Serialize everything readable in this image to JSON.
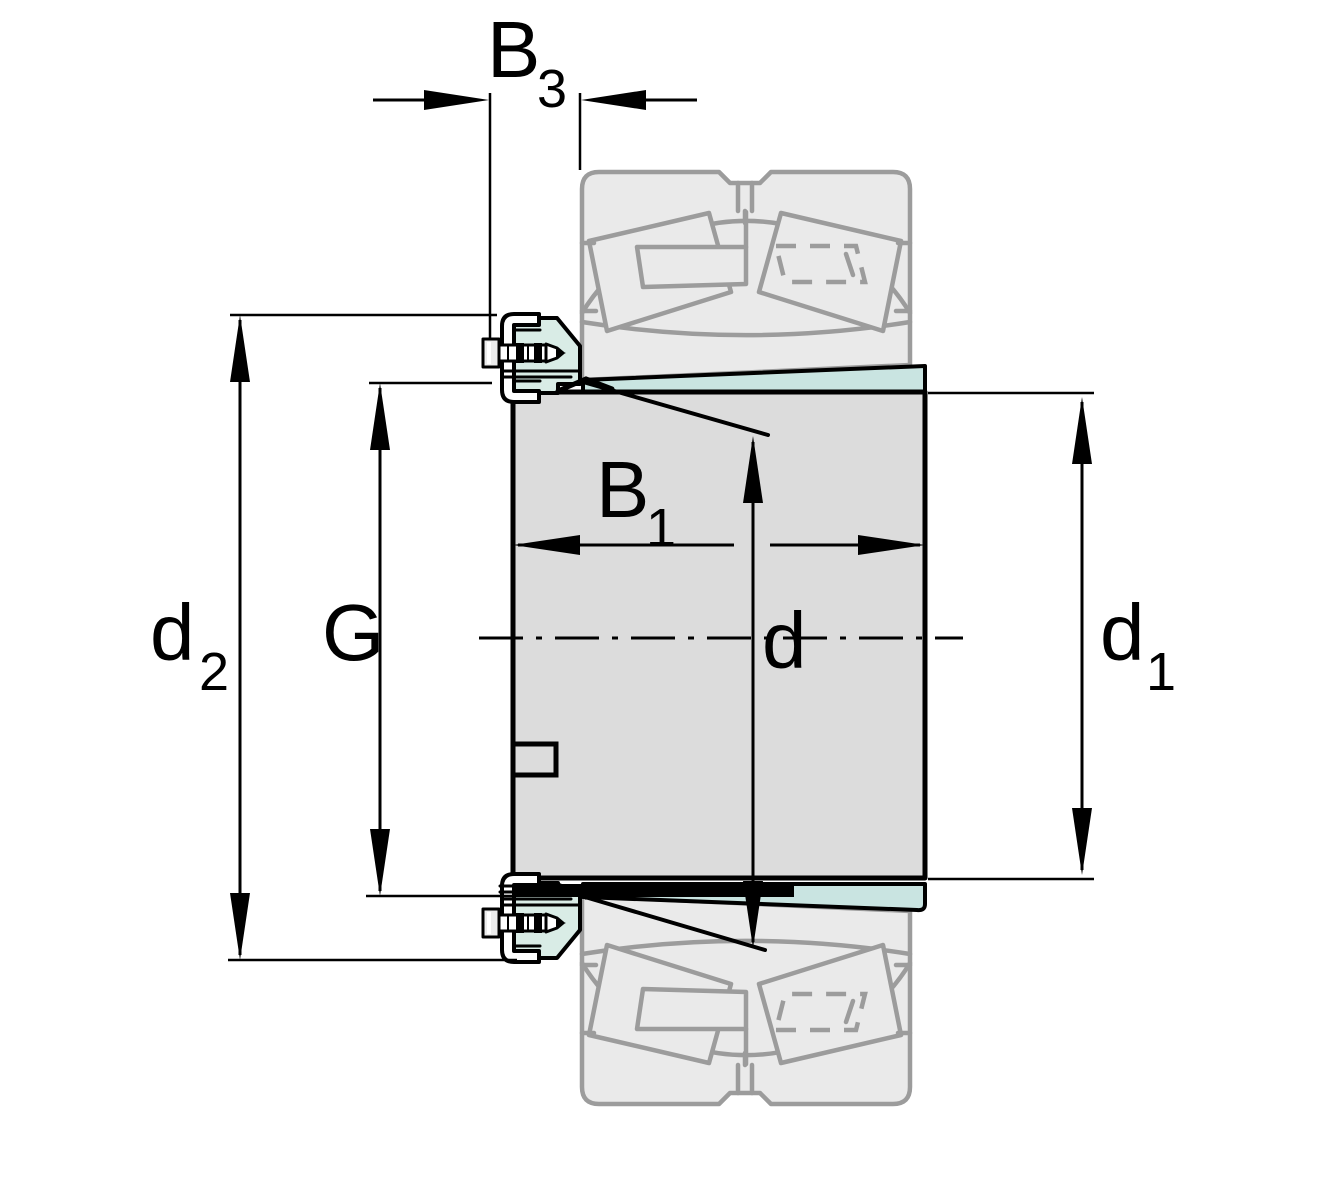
{
  "drawing": {
    "title": "Adapter sleeve with withdrawal nut and locking device - dimension drawing",
    "parts": {
      "ghost_bearing": "spherical-roller-bearing (phantom)",
      "sleeve": "tapered adapter sleeve",
      "nut": "lock nut with locking screw"
    }
  },
  "colors": {
    "background": "#ffffff",
    "outline": "#000000",
    "sleeve_fill": "#dcdcdc",
    "taper_fill": "#c9e4e1",
    "nut_fill": "#d9ece6",
    "nut_fill_light": "#eef7f2",
    "ghost_fill": "#eaeaea",
    "ghost_stroke": "#9c9c9c"
  },
  "dims": {
    "b3": {
      "main": "B",
      "sub": "3"
    },
    "b1": {
      "main": "B",
      "sub": "1"
    },
    "d2": {
      "main": "d",
      "sub": "2"
    },
    "g": {
      "main": "G",
      "sub": ""
    },
    "d": {
      "main": "d",
      "sub": ""
    },
    "d1": {
      "main": "d",
      "sub": "1"
    }
  }
}
